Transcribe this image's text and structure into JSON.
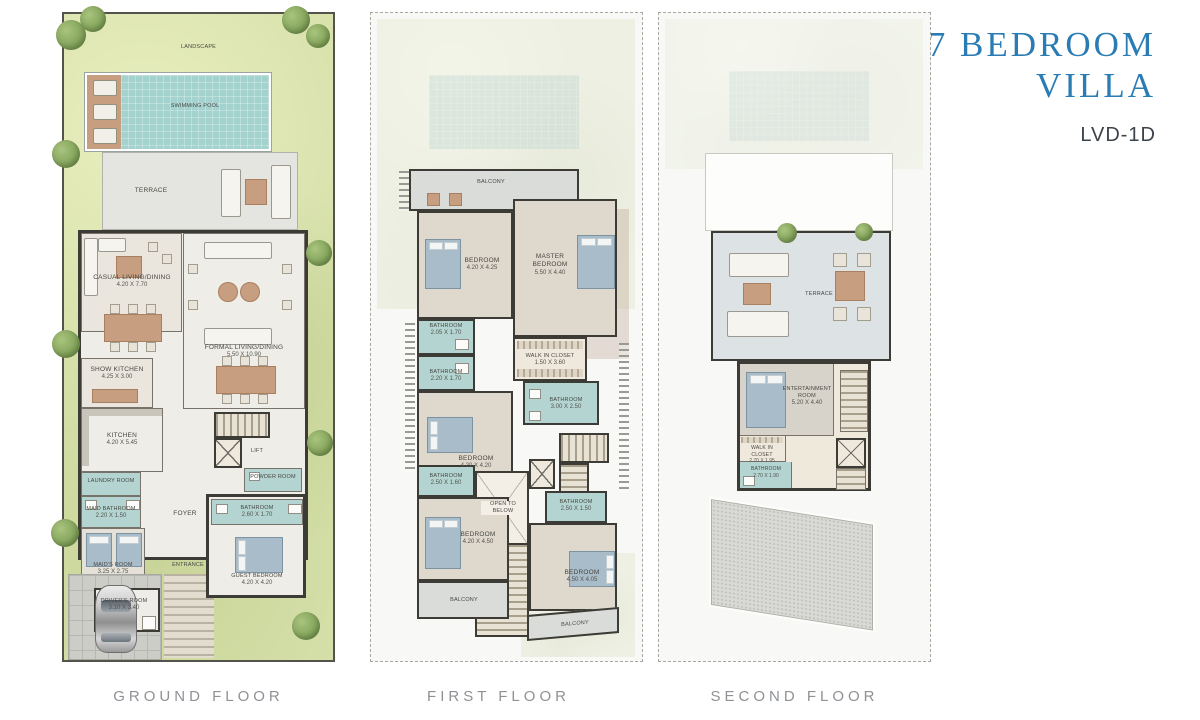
{
  "header": {
    "title_line1": "7 BEDROOM",
    "title_line2": "VILLA",
    "unit_code": "LVD-1D"
  },
  "colors": {
    "title_blue": "#2a7cb5",
    "grass_green": "#d7e1ab",
    "pool_aqua": "#a4d2cf",
    "bathroom_blue": "#b3d4d1",
    "wall_dark": "#3c3b35",
    "label_grey": "#8e9296"
  },
  "floors": [
    {
      "label": "GROUND FLOOR",
      "rooms": {
        "landscape": {
          "name": "LANDSCAPE"
        },
        "pool": {
          "name": "SWIMMING POOL"
        },
        "terrace": {
          "name": "TERRACE"
        },
        "casual_living": {
          "name": "CASUAL LIVING/DINING",
          "dims": "4.20 X 7.70"
        },
        "formal_living": {
          "name": "FORMAL LIVING/DINING",
          "dims": "5.50 X 10.90"
        },
        "show_kitchen": {
          "name": "SHOW KITCHEN",
          "dims": "4.25 X 3.00"
        },
        "kitchen": {
          "name": "KITCHEN",
          "dims": "4.20 X 5.45"
        },
        "laundry": {
          "name": "LAUNDRY ROOM"
        },
        "maid_bathroom": {
          "name": "MAID BATHROOM",
          "dims": "2.20 X 1.50"
        },
        "maids_room": {
          "name": "MAID'S ROOM",
          "dims": "3.25 X 2.75"
        },
        "drivers_room": {
          "name": "DRIVER'S ROOM",
          "dims": "3.10 X 3.40"
        },
        "foyer": {
          "name": "FOYER"
        },
        "entrance": {
          "name": "ENTRANCE"
        },
        "lift": {
          "name": "LIFT"
        },
        "powder_room": {
          "name": "POWDER ROOM"
        },
        "guest_bathroom": {
          "name": "BATHROOM",
          "dims": "2.60 X 1.70"
        },
        "guest_bedroom": {
          "name": "GUEST BEDROOM",
          "dims": "4.20 X 4.20"
        }
      }
    },
    {
      "label": "FIRST FLOOR",
      "rooms": {
        "balcony_top": {
          "name": "BALCONY"
        },
        "bedroom_1": {
          "name": "BEDROOM",
          "dims": "4.20 X 4.25"
        },
        "master_bedroom": {
          "name": "MASTER BEDROOM",
          "dims": "5.50 X 4.40"
        },
        "bathroom_1": {
          "name": "BATHROOM",
          "dims": "2.05 X 1.70"
        },
        "bathroom_2": {
          "name": "BATHROOM",
          "dims": "2.20 X 1.70"
        },
        "walk_in_closet": {
          "name": "WALK IN CLOSET",
          "dims": "1.50 X 3.60"
        },
        "bathroom_3": {
          "name": "BATHROOM",
          "dims": "3.00 X 2.50"
        },
        "bedroom_2": {
          "name": "BEDROOM",
          "dims": "4.20 X 4.20"
        },
        "bathroom_4": {
          "name": "BATHROOM",
          "dims": "2.50 X 1.60"
        },
        "open_to_below": {
          "name": "OPEN TO BELOW"
        },
        "bathroom_5": {
          "name": "BATHROOM",
          "dims": "2.50 X 1.50"
        },
        "bedroom_3": {
          "name": "BEDROOM",
          "dims": "4.20 X 4.50"
        },
        "bedroom_4": {
          "name": "BEDROOM",
          "dims": "4.50 X 4.05"
        },
        "balcony_left": {
          "name": "BALCONY"
        },
        "balcony_right": {
          "name": "BALCONY"
        }
      }
    },
    {
      "label": "SECOND FLOOR",
      "rooms": {
        "terrace": {
          "name": "TERRACE"
        },
        "entertainment": {
          "name": "ENTERTAINMENT ROOM",
          "dims": "5.20 X 4.40"
        },
        "walk_in_closet": {
          "name": "WALK IN CLOSET",
          "dims": "2.70 X 1.95"
        },
        "bathroom": {
          "name": "BATHROOM",
          "dims": "2.70 X 1.90"
        }
      }
    }
  ]
}
